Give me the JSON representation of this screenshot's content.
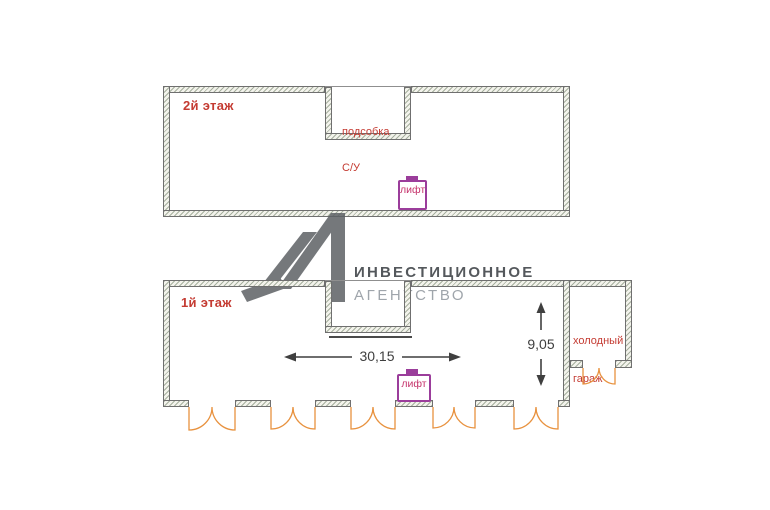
{
  "floor2": {
    "label": "2й этаж",
    "room": {
      "line1": "подсобка",
      "line2": "С/У"
    },
    "lift_label": "лифт"
  },
  "floor1": {
    "label": "1й этаж",
    "lift_label": "лифт",
    "garage": {
      "line1": "холодный",
      "line2": "гараж"
    },
    "dim_width": "30,15",
    "dim_height": "9,05"
  },
  "logo": {
    "line1": "ИНВЕСТИЦИОННОЕ",
    "line2": "АГЕНТСТВО"
  },
  "colors": {
    "label_red": "#c43b32",
    "lift_border": "#9b3d9b",
    "lift_text": "#c5336b",
    "door_arc_orange": "#e8923f",
    "dimension_dark": "#3f3f3f",
    "wall_fill": "#f3f3ec",
    "wall_hatch": "#7d8c76",
    "wall_edge": "#6f6f6f",
    "logo_mark_gray": "#5d6165",
    "logo_text_dark": "#54585c",
    "logo_text_light": "#9fa5ab"
  }
}
